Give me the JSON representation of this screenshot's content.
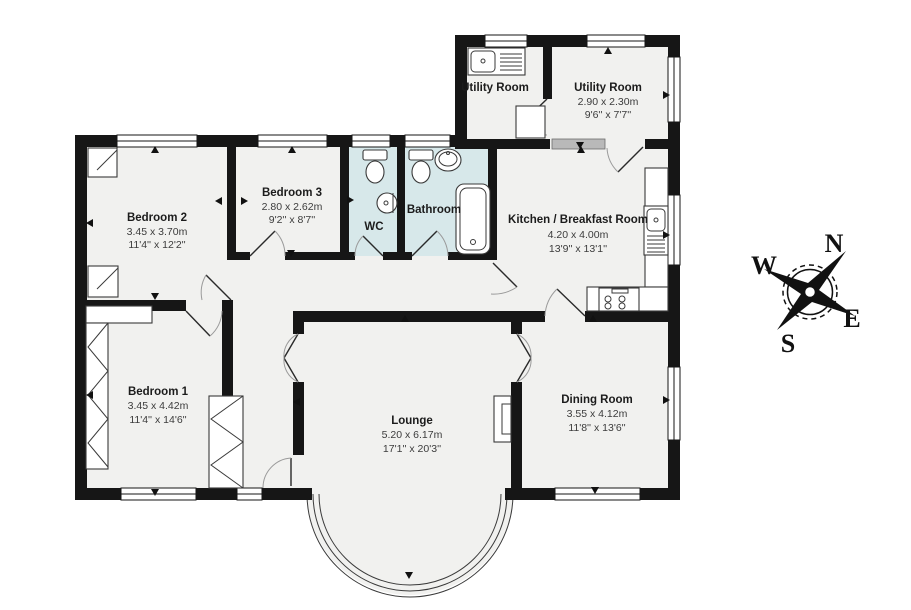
{
  "floorplan": {
    "rooms": {
      "bedroom2": {
        "name": "Bedroom 2",
        "metric": "3.45 x 3.70m",
        "imperial": "11'4'' x 12'2''"
      },
      "bedroom3": {
        "name": "Bedroom 3",
        "metric": "2.80 x 2.62m",
        "imperial": "9'2'' x 8'7''"
      },
      "wc": {
        "name": "WC"
      },
      "bathroom": {
        "name": "Bathroom"
      },
      "kitchen": {
        "name": "Kitchen / Breakfast Room",
        "metric": "4.20 x 4.00m",
        "imperial": "13'9'' x 13'1''"
      },
      "utility_left": {
        "name": "Utility Room"
      },
      "utility_right": {
        "name": "Utility Room",
        "metric": "2.90 x 2.30m",
        "imperial": "9'6'' x 7'7''"
      },
      "bedroom1": {
        "name": "Bedroom 1",
        "metric": "3.45 x 4.42m",
        "imperial": "11'4'' x 14'6''"
      },
      "lounge": {
        "name": "Lounge",
        "metric": "5.20 x 6.17m",
        "imperial": "17'1'' x 20'3''"
      },
      "dining": {
        "name": "Dining Room",
        "metric": "3.55 x 4.12m",
        "imperial": "11'8'' x 13'6''"
      }
    },
    "compass": {
      "n": "N",
      "e": "E",
      "s": "S",
      "w": "W"
    },
    "colors": {
      "wall": "#161616",
      "floor": "#f1f1ef",
      "wet_floor": "#d7e8ea",
      "background": "#ffffff"
    }
  }
}
